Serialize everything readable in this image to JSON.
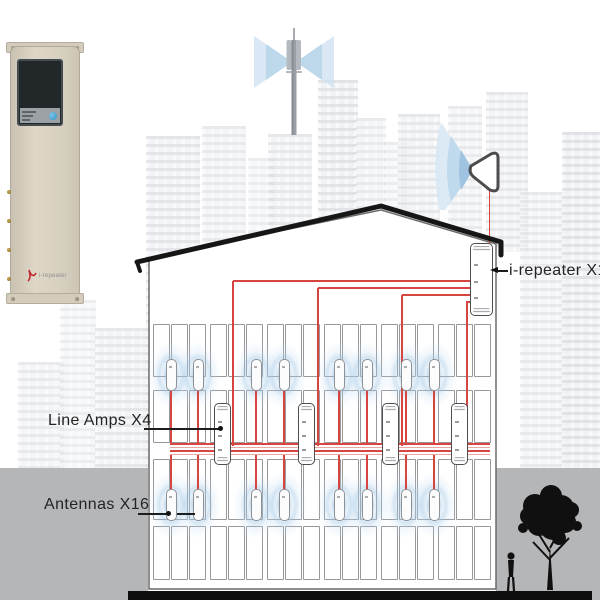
{
  "labels": {
    "repeater": "i-repeater X1",
    "line_amps": "Line Amps X4",
    "antennas": "Antennas X16"
  },
  "device_photo": {
    "brand": "i-repeater"
  },
  "counts": {
    "repeaters": 1,
    "line_amps": 4,
    "antennas": 16,
    "antenna_rows": 2,
    "antennas_per_row": 8,
    "window_rows": 4,
    "windows_per_row": 18,
    "led_rows": 5
  },
  "colors": {
    "cable": "#d6453f",
    "cable_light": "#eda5a0",
    "halo": "#9fc3e0",
    "ground": "#b5b6b8",
    "silhouette": "#0d0d0d",
    "device_beige": "#d6cfbf",
    "led_green": "#3ecf3e",
    "button_blue": "#3fa3dc"
  }
}
